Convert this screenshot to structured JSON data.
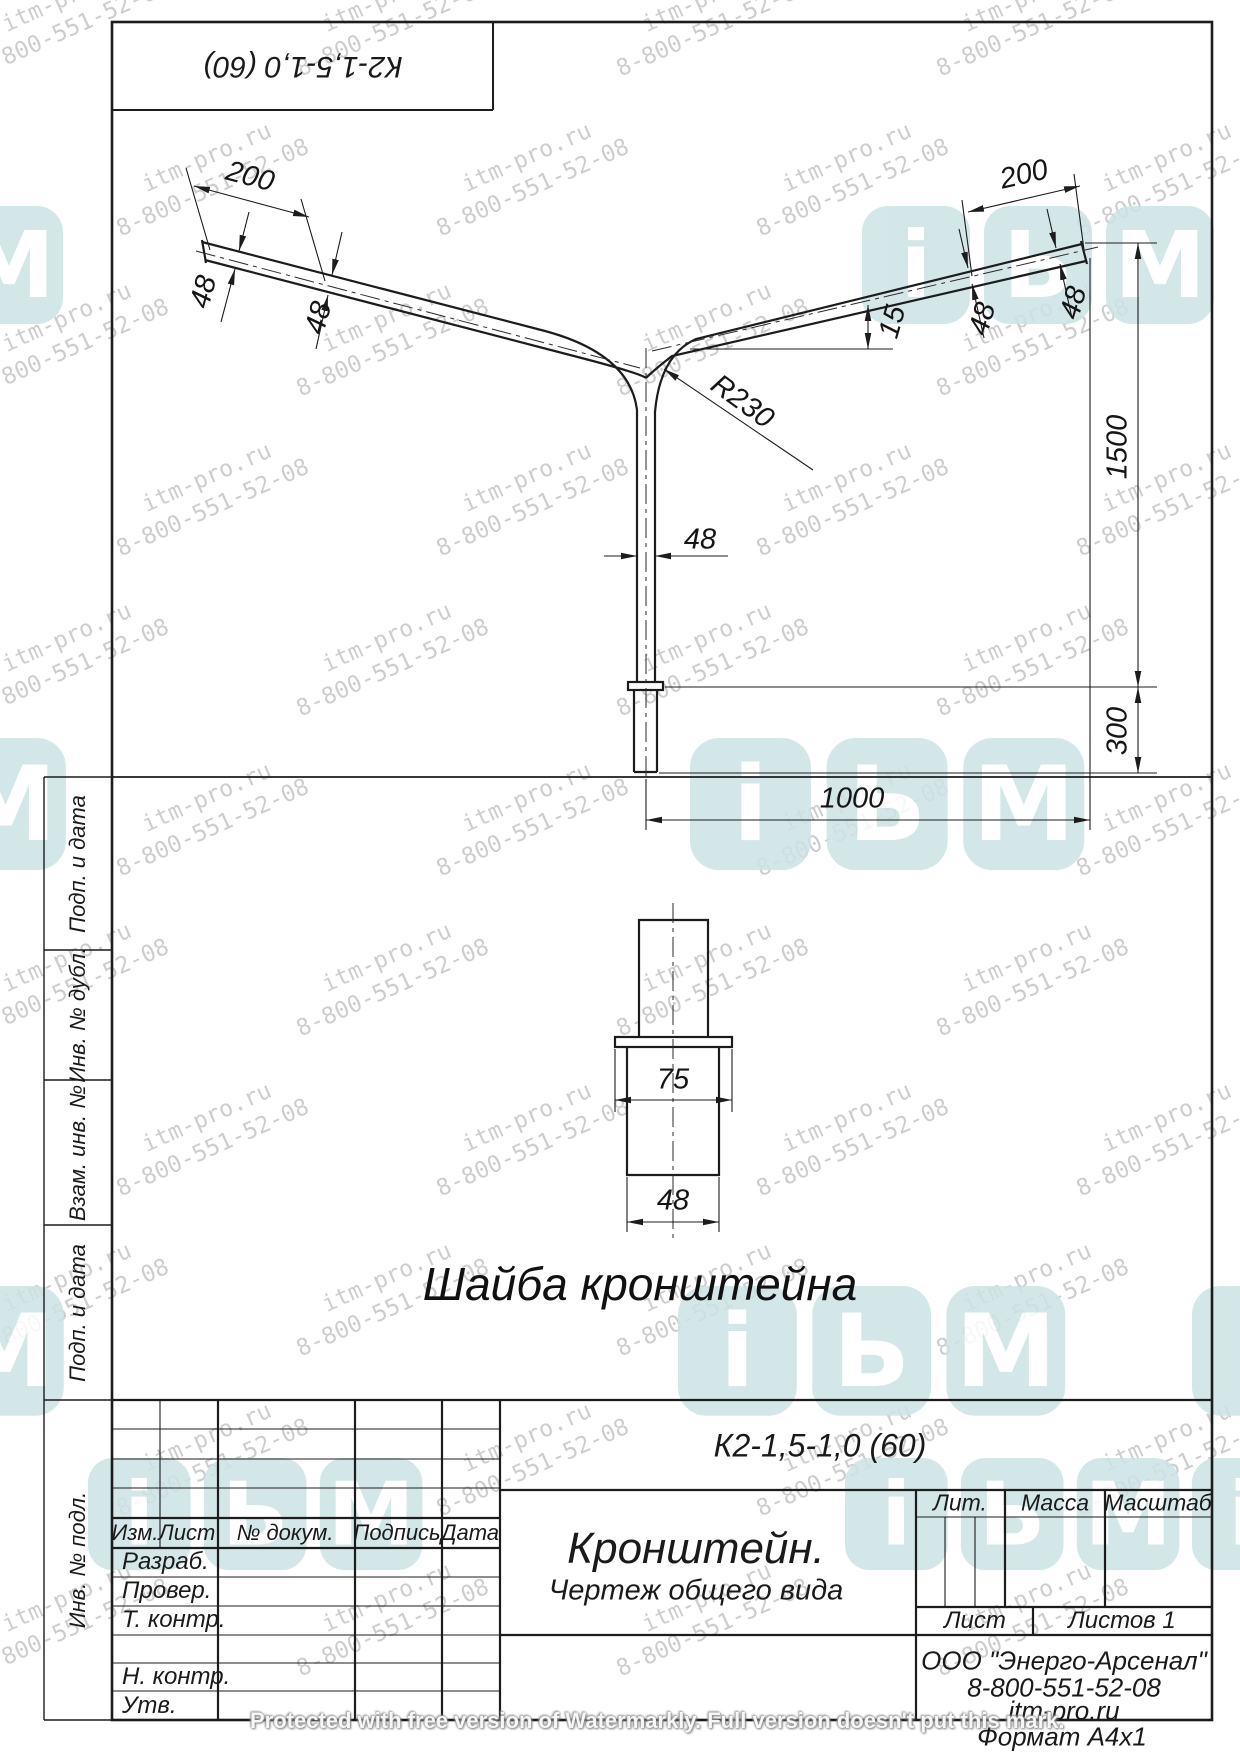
{
  "sheet": {
    "corner_designation": "К2-1,5-1,0 (60)",
    "format_label": "Формат  А4х1"
  },
  "drawing": {
    "washer_caption": "Шайба кронштейна",
    "dim_labels": [
      {
        "name": "left-arm-200",
        "text": "200",
        "x": 250,
        "y": 177,
        "rot": 15
      },
      {
        "name": "left-48-tip",
        "text": "48",
        "x": 204,
        "y": 292,
        "rot": -75
      },
      {
        "name": "left-48-mid",
        "text": "48",
        "x": 319,
        "y": 318,
        "rot": -75
      },
      {
        "name": "radius-r230",
        "text": "R230",
        "x": 742,
        "y": 402,
        "rot": 36
      },
      {
        "name": "slope-15",
        "text": "15",
        "x": 893,
        "y": 322,
        "rot": -74
      },
      {
        "name": "right-48-mid",
        "text": "48",
        "x": 983,
        "y": 319,
        "rot": -74
      },
      {
        "name": "right-48-tip",
        "text": "48",
        "x": 1074,
        "y": 303,
        "rot": -74
      },
      {
        "name": "right-arm-200",
        "text": "200",
        "x": 1024,
        "y": 175,
        "rot": -13
      },
      {
        "name": "pole-48",
        "text": "48",
        "x": 700,
        "y": 540,
        "rot": 0
      },
      {
        "name": "height-1500",
        "text": "1500",
        "x": 1118,
        "y": 447,
        "rot": -90
      },
      {
        "name": "base-300",
        "text": "300",
        "x": 1118,
        "y": 731,
        "rot": -90
      },
      {
        "name": "reach-1000",
        "text": "1000",
        "x": 852,
        "y": 799,
        "rot": 0
      },
      {
        "name": "washer-75",
        "text": "75",
        "x": 673,
        "y": 1080,
        "rot": 0
      },
      {
        "name": "washer-48",
        "text": "48",
        "x": 673,
        "y": 1201,
        "rot": 0
      }
    ]
  },
  "margin_column": {
    "cells": [
      {
        "label": "Подп. и дата",
        "y1": 777,
        "y2": 950
      },
      {
        "label": "Инв. № дубл.",
        "y1": 950,
        "y2": 1080
      },
      {
        "label": "Взам. инв. №",
        "y1": 1080,
        "y2": 1225
      },
      {
        "label": "Подп. и дата",
        "y1": 1225,
        "y2": 1400
      },
      {
        "label": "Инв. № подл.",
        "y1": 1400,
        "y2": 1720
      }
    ]
  },
  "title_block": {
    "designation": "К2-1,5-1,0 (60)",
    "doc_title": "Кронштейн.",
    "doc_subtitle": "Чертеж общего вида",
    "header_cells": [
      "Изм.",
      "Лист",
      "№ докум.",
      "Подпись",
      "Дата"
    ],
    "row_labels": [
      "Разраб.",
      "Провер.",
      "Т. контр.",
      "Н. контр.",
      "Утв."
    ],
    "lit_label": "Лит.",
    "mass_label": "Масса",
    "scale_label": "Масштаб",
    "sheet_label": "Лист",
    "sheets_label": "Листов 1",
    "company_lines": [
      "ООО \"Энерго-Арсенал\"",
      "8-800-551-52-08",
      "itm-pro.ru"
    ]
  },
  "watermark": {
    "line1": "itm-pro.ru",
    "line2": "8-800-551-52-08",
    "protect_text": "Protected with free version of Watermarkly. Full version doesn't put this mark.",
    "logo_color": "#cde3e5",
    "logo_letters": [
      "i",
      "Ь",
      "M"
    ],
    "logos": [
      {
        "x": -45,
        "y": 206,
        "s": 1,
        "tiles": [
          "M"
        ]
      },
      {
        "x": 862,
        "y": 206,
        "s": 1,
        "tiles": [
          "i",
          "Ь",
          "M"
        ]
      },
      {
        "x": -55,
        "y": 738,
        "s": 1.12,
        "tiles": [
          "M"
        ]
      },
      {
        "x": 690,
        "y": 738,
        "s": 1.12,
        "tiles": [
          "i",
          "Ь",
          "M"
        ]
      },
      {
        "x": -55,
        "y": 1286,
        "s": 1.1,
        "tiles": [
          "M"
        ]
      },
      {
        "x": 678,
        "y": 1286,
        "s": 1.1,
        "tiles": [
          "i",
          "Ь",
          "M"
        ]
      },
      {
        "x": 1192,
        "y": 1286,
        "s": 1.1,
        "tiles": [
          "i"
        ]
      },
      {
        "x": 88,
        "y": 1458,
        "s": 0.95,
        "tiles": [
          "i",
          "Ь",
          "M"
        ]
      },
      {
        "x": 845,
        "y": 1458,
        "s": 0.95,
        "tiles": [
          "i",
          "Ь",
          "M"
        ]
      },
      {
        "x": 1192,
        "y": 1458,
        "s": 0.95,
        "tiles": [
          "i"
        ]
      }
    ]
  }
}
